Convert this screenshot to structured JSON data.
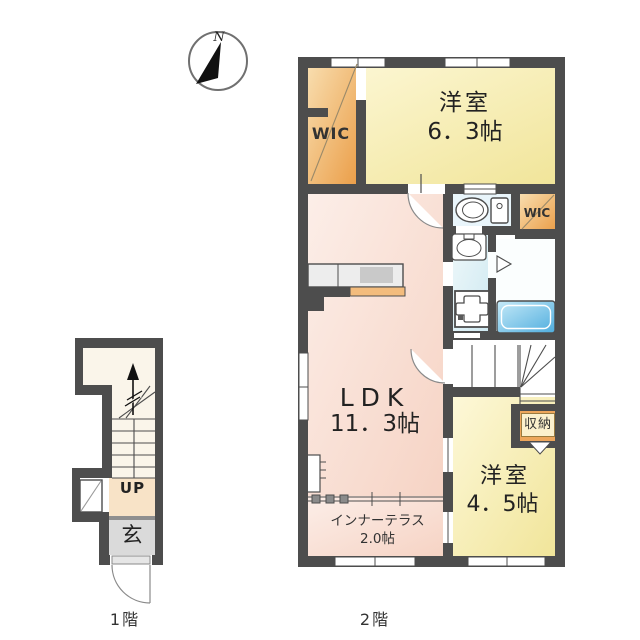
{
  "compass": {
    "north_label": "N"
  },
  "floor1": {
    "caption": "1階",
    "stairs_label": "UP",
    "entrance_label": "玄"
  },
  "floor2": {
    "caption": "2階",
    "bedroom1": {
      "name": "洋室",
      "area": "6．3帖"
    },
    "wic1": {
      "label": "WIC"
    },
    "wic2": {
      "label": "WIC"
    },
    "ldk": {
      "name": "LDK",
      "area": "11．3帖"
    },
    "storage": {
      "label": "収納"
    },
    "bedroom2": {
      "name": "洋室",
      "area": "4．5帖"
    },
    "terrace": {
      "name": "インナーテラス",
      "area": "2.0帖"
    }
  },
  "colors": {
    "wall": "#4d4d4d",
    "room_yellow": "#f1e59a",
    "wic_orange": "#eb9f4a",
    "ldk_pink": "#f6d3c4",
    "bath_blue": "#4fadde",
    "entrance_gray": "#dadada",
    "hall_beige": "#f8e3c7"
  }
}
